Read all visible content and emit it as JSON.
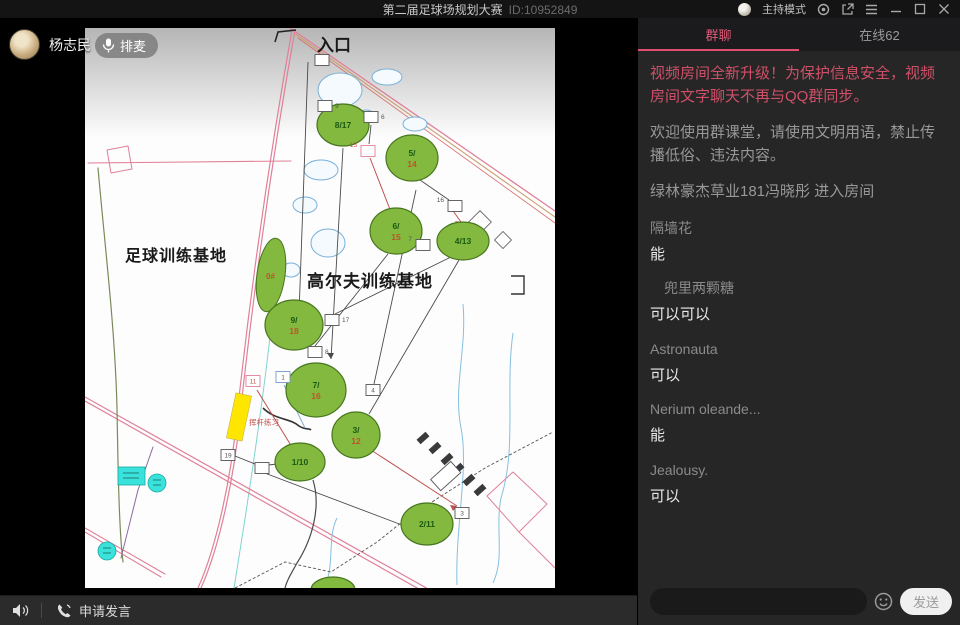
{
  "titlebar": {
    "title": "第二届足球场规划大赛",
    "room_id": "ID:10952849",
    "mode_label": "主持模式"
  },
  "presenter": {
    "name": "杨志民"
  },
  "video": {
    "paimai_label": "排麦"
  },
  "controls": {
    "apply_speak_label": "申请发言"
  },
  "chat": {
    "tabs": [
      {
        "label": "群聊",
        "active": true
      },
      {
        "label": "在线62",
        "active": false
      }
    ],
    "messages": [
      {
        "type": "alert",
        "text": "视频房间全新升级！为保护信息安全，视频房间文字聊天不再与QQ群同步。"
      },
      {
        "type": "sys",
        "text": "欢迎使用群课堂，请使用文明用语，禁止传播低俗、违法内容。"
      },
      {
        "type": "sys",
        "text": "绿林豪杰草业181冯晓彤 进入房间"
      },
      {
        "type": "user",
        "name": "隔墙花",
        "text": "能"
      },
      {
        "type": "user",
        "name": "　兜里两颗糖",
        "text": "可以可以"
      },
      {
        "type": "user",
        "name": "Astronauta",
        "text": "可以"
      },
      {
        "type": "user",
        "name": "Nerium oleande...",
        "text": "能"
      },
      {
        "type": "user",
        "name": "Jealousy.",
        "text": "可以"
      }
    ],
    "input": {
      "placeholder": "",
      "send_label": "发送"
    }
  },
  "map": {
    "entrance_label": "入口",
    "football_label": "足球训练基地",
    "golf_label": "高尔夫训练基地",
    "swing_label": "挥杆练习",
    "zero_label": "0#",
    "greens": [
      {
        "x": 258,
        "y": 97,
        "rx": 26,
        "ry": 21,
        "lines": [
          "8/17"
        ]
      },
      {
        "x": 327,
        "y": 130,
        "rx": 26,
        "ry": 23,
        "lines": [
          "5/",
          "14"
        ]
      },
      {
        "x": 311,
        "y": 203,
        "rx": 26,
        "ry": 23,
        "lines": [
          "6/",
          "15"
        ]
      },
      {
        "x": 378,
        "y": 213,
        "rx": 26,
        "ry": 19,
        "lines": [
          "4/13"
        ]
      },
      {
        "x": 209,
        "y": 297,
        "rx": 29,
        "ry": 25,
        "lines": [
          "9/",
          "18"
        ]
      },
      {
        "x": 231,
        "y": 362,
        "rx": 30,
        "ry": 27,
        "lines": [
          "7/",
          "16"
        ]
      },
      {
        "x": 215,
        "y": 434,
        "rx": 25,
        "ry": 19,
        "lines": [
          "1/10"
        ]
      },
      {
        "x": 271,
        "y": 407,
        "rx": 24,
        "ry": 23,
        "lines": [
          "3/",
          "12"
        ]
      },
      {
        "x": 342,
        "y": 496,
        "rx": 26,
        "ry": 21,
        "lines": [
          "2/11"
        ]
      },
      {
        "x": 248,
        "y": 562,
        "rx": 22,
        "ry": 13,
        "lines": []
      }
    ],
    "tees": [
      {
        "x": 237,
        "y": 32,
        "label": "",
        "border": "dark",
        "pos": "right"
      },
      {
        "x": 240,
        "y": 78,
        "label": "9",
        "border": "dark",
        "pos": "right"
      },
      {
        "x": 286,
        "y": 89,
        "label": "6",
        "border": "dark",
        "pos": "right"
      },
      {
        "x": 283,
        "y": 123,
        "label": "15",
        "border": "pink",
        "pos": "left"
      },
      {
        "x": 370,
        "y": 178,
        "label": "16",
        "border": "dark",
        "pos": "left"
      },
      {
        "x": 338,
        "y": 217,
        "label": "7",
        "border": "dark",
        "pos": "left"
      },
      {
        "x": 247,
        "y": 292,
        "label": "17",
        "border": "dark",
        "pos": "right"
      },
      {
        "x": 230,
        "y": 324,
        "label": "8",
        "border": "dark",
        "pos": "right"
      },
      {
        "x": 168,
        "y": 353,
        "label": "11",
        "border": "pink",
        "pos": "inside"
      },
      {
        "x": 198,
        "y": 349,
        "label": "1",
        "border": "blue",
        "pos": "inside"
      },
      {
        "x": 143,
        "y": 427,
        "label": "19",
        "border": "dark",
        "pos": "inside"
      },
      {
        "x": 177,
        "y": 440,
        "label": "",
        "border": "dark",
        "pos": "inside"
      },
      {
        "x": 288,
        "y": 362,
        "label": "4",
        "border": "dark",
        "pos": "inside"
      },
      {
        "x": 377,
        "y": 485,
        "label": "3",
        "border": "dark",
        "pos": "inside"
      }
    ]
  },
  "colors": {
    "accent_pink": "#e15a78",
    "alert_text": "#cf5068",
    "green_fill": "#82b93e",
    "green_stroke": "#48761f",
    "green_label": "#1c5a12",
    "red_label": "#c0522e",
    "road_pink": "#e08098",
    "pond_blue": "#79b0d8",
    "cyan_fill": "#39e3dc",
    "tee_dark": "#555555",
    "tee_pink": "#e08098",
    "tee_blue": "#7799cc",
    "yellow_fill": "#ffe600"
  }
}
